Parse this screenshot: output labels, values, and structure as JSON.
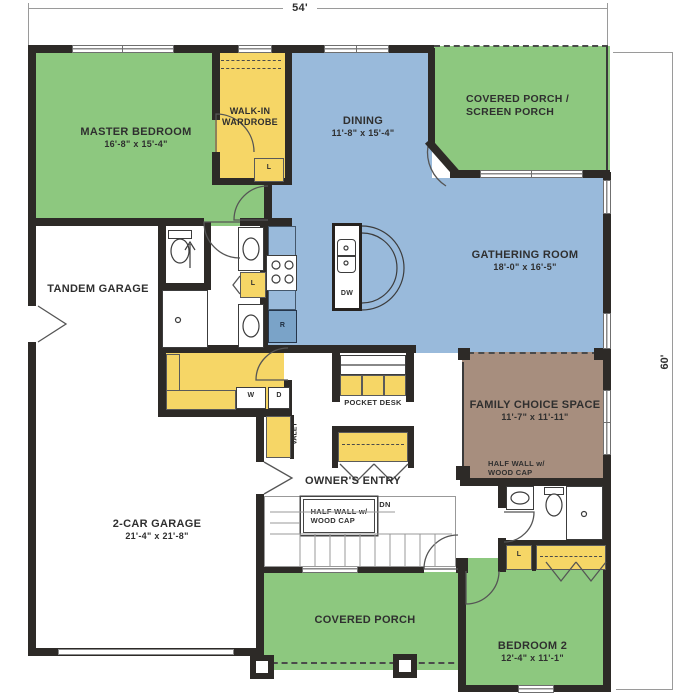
{
  "plan": {
    "width_label": "54'",
    "height_label": "60'"
  },
  "rooms": {
    "master_bedroom": {
      "name": "MASTER BEDROOM",
      "size": "16'-8\" x 15'-4\""
    },
    "walk_in_wardrobe": {
      "line1": "WALK-IN",
      "line2": "WARDROBE"
    },
    "dining": {
      "name": "DINING",
      "size": "11'-8\" x 15'-4\""
    },
    "screen_porch": {
      "line1": "COVERED PORCH /",
      "line2": "SCREEN PORCH"
    },
    "gathering_room": {
      "name": "GATHERING ROOM",
      "size": "18'-0\" x 16'-5\""
    },
    "tandem_garage": {
      "name": "TANDEM GARAGE"
    },
    "family_choice_space": {
      "name": "FAMILY CHOICE SPACE",
      "size": "11'-7\" x 11'-11\"",
      "note1": "HALF WALL w/",
      "note2": "WOOD CAP"
    },
    "pocket_desk": {
      "name": "POCKET DESK"
    },
    "owners_entry": {
      "name": "OWNER'S ENTRY"
    },
    "stairs": {
      "note1": "HALF WALL w/",
      "note2": "WOOD CAP",
      "dn": "DN"
    },
    "valet": {
      "name": "VALET"
    },
    "two_car_garage": {
      "name": "2-CAR GARAGE",
      "size": "21'-4\" x 21'-8\""
    },
    "covered_porch": {
      "name": "COVERED PORCH"
    },
    "bedroom_2": {
      "name": "BEDROOM 2",
      "size": "12'-4\" x 11'-1\""
    }
  },
  "labels": {
    "washer": "W",
    "dryer": "D",
    "dishwasher": "DW",
    "refrigerator": "R",
    "linen_wardrobe": "L",
    "linen_master": "L",
    "linen_hall": "L"
  },
  "colors": {
    "bedroom_green": "#8dc87f",
    "living_blue": "#99badb",
    "storage_yellow": "#f6d666",
    "flex_brown": "#a78e7e",
    "wall": "#2d2a27"
  }
}
